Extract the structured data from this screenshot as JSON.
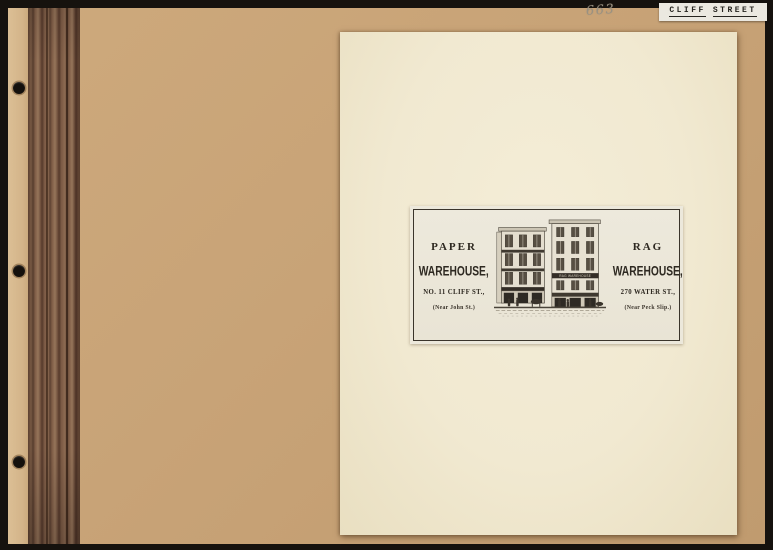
{
  "photo": {
    "handwritten_number": "663",
    "corner_label": "CLIFF STREET",
    "corner_label_words": [
      "CLIFF",
      "STREET"
    ]
  },
  "advert": {
    "paper_side": {
      "title": "PAPER",
      "subtitle": "WAREHOUSE,",
      "address": "NO. 11 CLIFF ST.,",
      "cross_street": "(Near John St.)"
    },
    "rag_side": {
      "title": "RAG",
      "subtitle": "WAREHOUSE,",
      "address": "270 WATER ST.,",
      "cross_street": "(Near Peck Slip.)"
    },
    "rag_building_sign": "RAG WAREHOUSE"
  },
  "colors": {
    "scan_border": "#16120e",
    "album_page": "#c8a377",
    "binding_brown": "#7a5843",
    "mounted_sheet": "#f1e9d1",
    "plate_paper": "#ece8db",
    "engraving_ink": "#2e2921",
    "label_paper": "#ebe8e0",
    "pencil_gray": "#9a9181"
  }
}
